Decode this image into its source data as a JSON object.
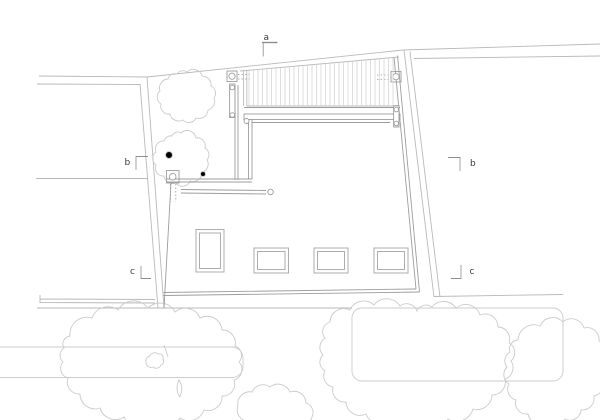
{
  "plan": {
    "section_markers": {
      "a": {
        "label": "a"
      },
      "b_left": {
        "label": "b"
      },
      "b_right": {
        "label": "b"
      },
      "c_left": {
        "label": "c"
      },
      "c_right": {
        "label": "c"
      }
    },
    "colors": {
      "background": "#ffffff",
      "parcel_line": "#b9b9b9",
      "building_line": "#9d9d9d",
      "skylight_line": "#a5a5a5",
      "slat_line": "#d5d5d5",
      "vegetation_line": "#cbcbcb",
      "beam_fill": "#dedede",
      "post_fill": "#e7e7e7",
      "marker_text": "#3b3b3b",
      "marker_line": "#8d8d8d"
    }
  }
}
